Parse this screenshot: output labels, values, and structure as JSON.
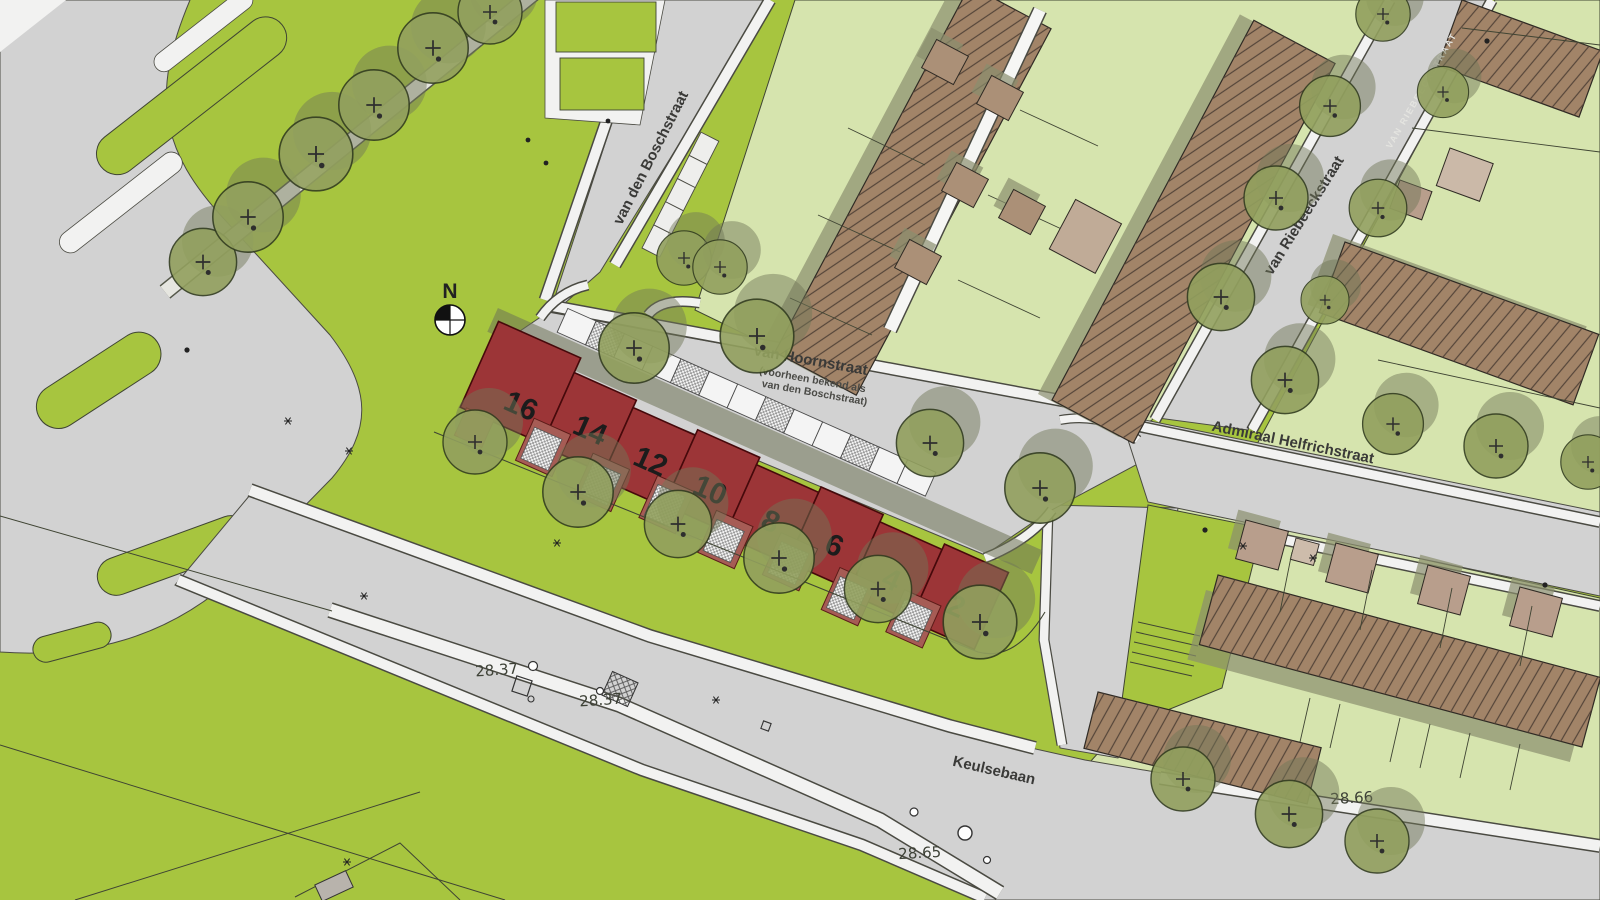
{
  "north_arrow": {
    "label": "N"
  },
  "streets": {
    "van_den_boschstraat": "van den Boschstraat",
    "van_hoornstraat": "van Hoornstraat",
    "van_hoornstraat_note1": "(voorheen bekend als",
    "van_hoornstraat_note2": "van den Boschstraat)",
    "van_riebeeckstraat": "van Riebeeckstraat",
    "van_riebeeckstraat_caps": "VAN RIEBEECKSTRAAT",
    "admiraal_helfrichstraat": "Admiraal Helfrichstraat",
    "keulsebaan": "Keulsebaan"
  },
  "house_numbers": [
    "16",
    "14",
    "12",
    "10",
    "8",
    "6",
    "4",
    "2"
  ],
  "elevation_marks": [
    "28.37",
    "28.37",
    "28.65",
    "28.66"
  ],
  "colors": {
    "grass": "#a7c53f",
    "garden": "#d6e4ae",
    "road": "#d2d2d2",
    "sidewalk": "#f2f2f1",
    "roof": "#a28468",
    "roof_stripe": "#554539",
    "shed": "#ab9077",
    "shed_light": "#cbb9a8",
    "shadow_olive": "#6e7355",
    "tree_crown": "#92a05e",
    "building_red": "#9c3537",
    "building_red_light": "#a65c55",
    "building_red_bright": "#c74b3f",
    "outline": "#3f4433",
    "label_text": "#3a3a38"
  }
}
